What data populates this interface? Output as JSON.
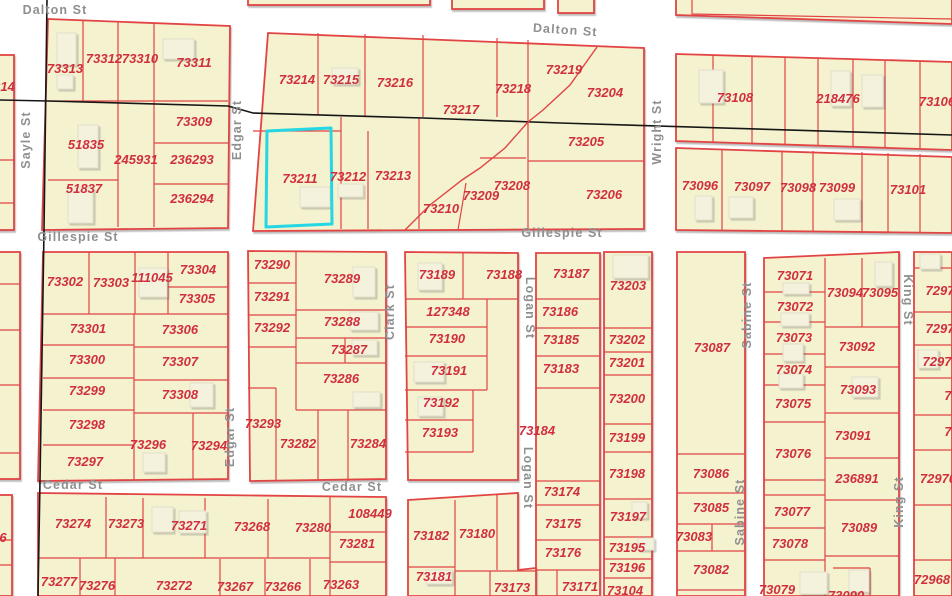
{
  "map": {
    "background": "#ffffff",
    "block_fill": "#f4f2cf",
    "lot_line_color": "#e24444",
    "parcel_label_color": "#d02f3d",
    "street_label_color": "#8f8f8f",
    "highlight_color": "#25d7e3",
    "survey_line_color": "#161616",
    "selected_parcel": "73211"
  },
  "street_labels": [
    {
      "t": "Dalton St",
      "x": 55,
      "y": 14,
      "r": 0
    },
    {
      "t": "Dalton St",
      "x": 565,
      "y": 34,
      "r": 4
    },
    {
      "t": "Sayle St",
      "x": 30,
      "y": 140,
      "r": -90
    },
    {
      "t": "Edgar St",
      "x": 241,
      "y": 130,
      "r": -90
    },
    {
      "t": "Edgar St",
      "x": 234,
      "y": 437,
      "r": -90
    },
    {
      "t": "Wright St",
      "x": 661,
      "y": 132,
      "r": -90
    },
    {
      "t": "Gillespie St",
      "x": 78,
      "y": 241,
      "r": 0
    },
    {
      "t": "Gillespie St",
      "x": 562,
      "y": 237,
      "r": 0
    },
    {
      "t": "Clark St",
      "x": 394,
      "y": 312,
      "r": -90
    },
    {
      "t": "Logan St",
      "x": 526,
      "y": 308,
      "r": 90
    },
    {
      "t": "Logan St",
      "x": 524,
      "y": 478,
      "r": 90
    },
    {
      "t": "Sabine St",
      "x": 751,
      "y": 315,
      "r": -90
    },
    {
      "t": "Sabine St",
      "x": 744,
      "y": 512,
      "r": -90
    },
    {
      "t": "King St",
      "x": 904,
      "y": 300,
      "r": 90
    },
    {
      "t": "King St",
      "x": 903,
      "y": 502,
      "r": -90
    },
    {
      "t": "Cedar St",
      "x": 73,
      "y": 489,
      "r": 0
    },
    {
      "t": "Cedar St",
      "x": 352,
      "y": 491,
      "r": 0
    }
  ],
  "parcel_labels": [
    {
      "t": "214",
      "x": 4,
      "y": 91
    },
    {
      "t": "73313",
      "x": 65,
      "y": 73
    },
    {
      "t": "73312",
      "x": 104,
      "y": 63
    },
    {
      "t": "73310",
      "x": 140,
      "y": 63
    },
    {
      "t": "73311",
      "x": 194,
      "y": 67
    },
    {
      "t": "73309",
      "x": 194,
      "y": 126
    },
    {
      "t": "51835",
      "x": 86,
      "y": 149
    },
    {
      "t": "245931",
      "x": 136,
      "y": 164
    },
    {
      "t": "236293",
      "x": 192,
      "y": 164
    },
    {
      "t": "51837",
      "x": 84,
      "y": 193
    },
    {
      "t": "236294",
      "x": 192,
      "y": 203
    },
    {
      "t": "73214",
      "x": 297,
      "y": 84
    },
    {
      "t": "73215",
      "x": 341,
      "y": 84
    },
    {
      "t": "73216",
      "x": 395,
      "y": 87
    },
    {
      "t": "73217",
      "x": 461,
      "y": 114
    },
    {
      "t": "73218",
      "x": 513,
      "y": 93
    },
    {
      "t": "73219",
      "x": 564,
      "y": 74
    },
    {
      "t": "73204",
      "x": 605,
      "y": 97
    },
    {
      "t": "73211",
      "x": 300,
      "y": 183
    },
    {
      "t": "73212",
      "x": 348,
      "y": 181
    },
    {
      "t": "73213",
      "x": 393,
      "y": 180
    },
    {
      "t": "73210",
      "x": 441,
      "y": 213
    },
    {
      "t": "73209",
      "x": 481,
      "y": 200
    },
    {
      "t": "73208",
      "x": 512,
      "y": 190
    },
    {
      "t": "73205",
      "x": 586,
      "y": 146
    },
    {
      "t": "73206",
      "x": 604,
      "y": 199
    },
    {
      "t": "73108",
      "x": 735,
      "y": 102
    },
    {
      "t": "218476",
      "x": 838,
      "y": 103
    },
    {
      "t": "73106",
      "x": 937,
      "y": 106
    },
    {
      "t": "73096",
      "x": 700,
      "y": 190
    },
    {
      "t": "73097",
      "x": 752,
      "y": 191
    },
    {
      "t": "73098",
      "x": 798,
      "y": 192
    },
    {
      "t": "73099",
      "x": 837,
      "y": 192
    },
    {
      "t": "73101",
      "x": 908,
      "y": 194
    },
    {
      "t": "73302",
      "x": 65,
      "y": 286
    },
    {
      "t": "73303",
      "x": 111,
      "y": 287
    },
    {
      "t": "111045",
      "x": 152,
      "y": 282
    },
    {
      "t": "73304",
      "x": 198,
      "y": 274
    },
    {
      "t": "73305",
      "x": 197,
      "y": 303
    },
    {
      "t": "73301",
      "x": 88,
      "y": 333
    },
    {
      "t": "73306",
      "x": 180,
      "y": 334
    },
    {
      "t": "73300",
      "x": 87,
      "y": 364
    },
    {
      "t": "73307",
      "x": 180,
      "y": 366
    },
    {
      "t": "73299",
      "x": 87,
      "y": 395
    },
    {
      "t": "73308",
      "x": 180,
      "y": 399
    },
    {
      "t": "73298",
      "x": 87,
      "y": 429
    },
    {
      "t": "73296",
      "x": 148,
      "y": 449
    },
    {
      "t": "73294",
      "x": 209,
      "y": 450
    },
    {
      "t": "73297",
      "x": 85,
      "y": 466
    },
    {
      "t": "73290",
      "x": 272,
      "y": 269
    },
    {
      "t": "73289",
      "x": 342,
      "y": 283
    },
    {
      "t": "73291",
      "x": 272,
      "y": 301
    },
    {
      "t": "73292",
      "x": 272,
      "y": 332
    },
    {
      "t": "73288",
      "x": 342,
      "y": 326
    },
    {
      "t": "73287",
      "x": 349,
      "y": 354
    },
    {
      "t": "73286",
      "x": 341,
      "y": 383
    },
    {
      "t": "73293",
      "x": 263,
      "y": 428
    },
    {
      "t": "73282",
      "x": 298,
      "y": 448
    },
    {
      "t": "73284",
      "x": 368,
      "y": 448
    },
    {
      "t": "73189",
      "x": 437,
      "y": 279
    },
    {
      "t": "73188",
      "x": 504,
      "y": 279
    },
    {
      "t": "127348",
      "x": 448,
      "y": 316
    },
    {
      "t": "73190",
      "x": 447,
      "y": 343
    },
    {
      "t": "73191",
      "x": 449,
      "y": 375
    },
    {
      "t": "73192",
      "x": 441,
      "y": 407
    },
    {
      "t": "73193",
      "x": 440,
      "y": 437
    },
    {
      "t": "73187",
      "x": 571,
      "y": 278
    },
    {
      "t": "73186",
      "x": 560,
      "y": 316
    },
    {
      "t": "73185",
      "x": 561,
      "y": 344
    },
    {
      "t": "73183",
      "x": 561,
      "y": 373
    },
    {
      "t": "73184",
      "x": 537,
      "y": 435
    },
    {
      "t": "73203",
      "x": 628,
      "y": 290
    },
    {
      "t": "73202",
      "x": 627,
      "y": 344
    },
    {
      "t": "73201",
      "x": 627,
      "y": 367
    },
    {
      "t": "73200",
      "x": 627,
      "y": 403
    },
    {
      "t": "73199",
      "x": 627,
      "y": 442
    },
    {
      "t": "73198",
      "x": 627,
      "y": 478
    },
    {
      "t": "73197",
      "x": 628,
      "y": 521
    },
    {
      "t": "73195",
      "x": 627,
      "y": 552
    },
    {
      "t": "73196",
      "x": 627,
      "y": 572
    },
    {
      "t": "73104",
      "x": 625,
      "y": 595
    },
    {
      "t": "73087",
      "x": 712,
      "y": 352
    },
    {
      "t": "73086",
      "x": 711,
      "y": 478
    },
    {
      "t": "73085",
      "x": 711,
      "y": 512
    },
    {
      "t": "73083",
      "x": 694,
      "y": 541
    },
    {
      "t": "73082",
      "x": 711,
      "y": 574
    },
    {
      "t": "73071",
      "x": 795,
      "y": 280
    },
    {
      "t": "73072",
      "x": 795,
      "y": 311
    },
    {
      "t": "73073",
      "x": 794,
      "y": 342
    },
    {
      "t": "73074",
      "x": 794,
      "y": 374
    },
    {
      "t": "73075",
      "x": 793,
      "y": 408
    },
    {
      "t": "73076",
      "x": 793,
      "y": 458
    },
    {
      "t": "73077",
      "x": 792,
      "y": 516
    },
    {
      "t": "73078",
      "x": 790,
      "y": 548
    },
    {
      "t": "73079",
      "x": 777,
      "y": 594
    },
    {
      "t": "73094",
      "x": 845,
      "y": 297
    },
    {
      "t": "73095",
      "x": 880,
      "y": 297
    },
    {
      "t": "73092",
      "x": 857,
      "y": 351
    },
    {
      "t": "73093",
      "x": 858,
      "y": 394
    },
    {
      "t": "73091",
      "x": 853,
      "y": 440
    },
    {
      "t": "236891",
      "x": 857,
      "y": 483
    },
    {
      "t": "73089",
      "x": 859,
      "y": 532
    },
    {
      "t": "73090",
      "x": 846,
      "y": 600
    },
    {
      "t": "7297",
      "x": 940,
      "y": 295
    },
    {
      "t": "7297",
      "x": 940,
      "y": 333
    },
    {
      "t": "7297",
      "x": 937,
      "y": 366
    },
    {
      "t": "7",
      "x": 948,
      "y": 400
    },
    {
      "t": "7",
      "x": 948,
      "y": 436
    },
    {
      "t": "72970",
      "x": 938,
      "y": 483
    },
    {
      "t": "72968",
      "x": 932,
      "y": 584
    },
    {
      "t": "73274",
      "x": 73,
      "y": 528
    },
    {
      "t": "73273",
      "x": 126,
      "y": 528
    },
    {
      "t": "73271",
      "x": 189,
      "y": 530
    },
    {
      "t": "73268",
      "x": 252,
      "y": 531
    },
    {
      "t": "73280",
      "x": 313,
      "y": 532
    },
    {
      "t": "73277",
      "x": 59,
      "y": 586
    },
    {
      "t": "73276",
      "x": 97,
      "y": 590
    },
    {
      "t": "73272",
      "x": 174,
      "y": 590
    },
    {
      "t": "73267",
      "x": 235,
      "y": 591
    },
    {
      "t": "73266",
      "x": 283,
      "y": 591
    },
    {
      "t": "73263",
      "x": 341,
      "y": 589
    },
    {
      "t": "108449",
      "x": 370,
      "y": 518
    },
    {
      "t": "73281",
      "x": 357,
      "y": 548
    },
    {
      "t": "73182",
      "x": 431,
      "y": 540
    },
    {
      "t": "73180",
      "x": 477,
      "y": 538
    },
    {
      "t": "73181",
      "x": 434,
      "y": 581
    },
    {
      "t": "73173",
      "x": 512,
      "y": 592
    },
    {
      "t": "73171",
      "x": 580,
      "y": 591
    },
    {
      "t": "73174",
      "x": 562,
      "y": 496
    },
    {
      "t": "73175",
      "x": 563,
      "y": 528
    },
    {
      "t": "73176",
      "x": 563,
      "y": 557
    },
    {
      "t": "6",
      "x": 3,
      "y": 542
    }
  ]
}
